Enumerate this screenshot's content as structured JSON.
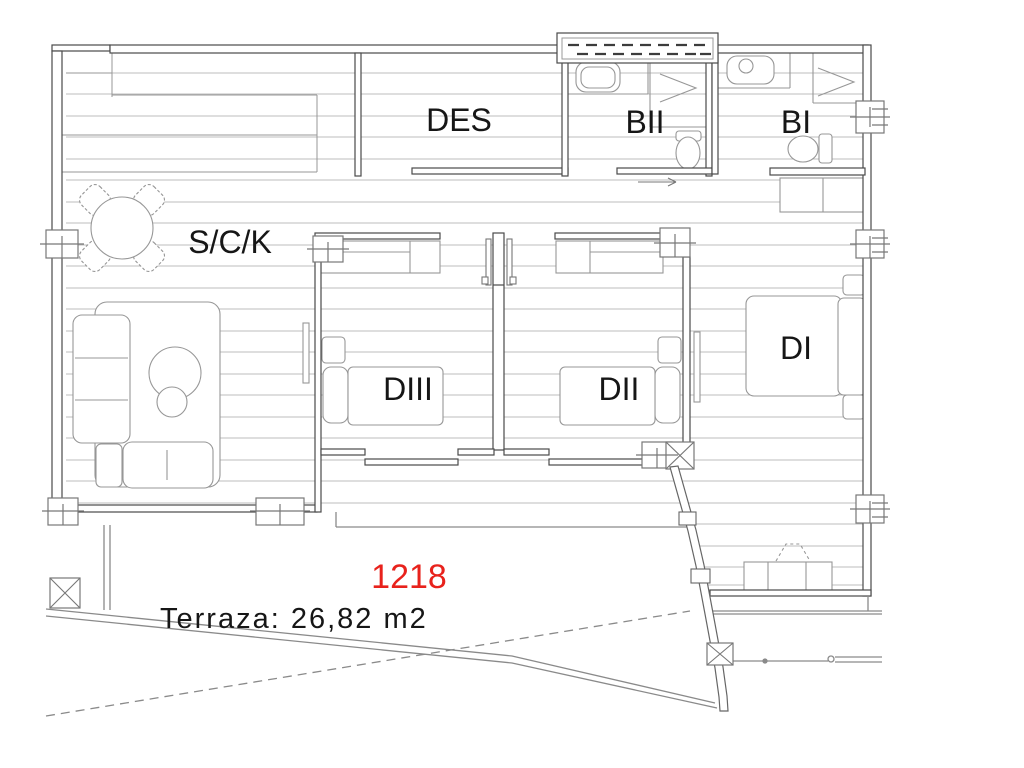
{
  "plan": {
    "unit_number": "1218",
    "terrace_label": "Terraza: 26,82 m2",
    "rooms": {
      "des": "DES",
      "bii": "BII",
      "bi": "BI",
      "sck": "S/C/K",
      "diii": "DIII",
      "dii": "DII",
      "di": "DI"
    },
    "colors": {
      "background": "#ffffff",
      "unit_number_red": "#e8221c",
      "label_black": "#161616",
      "wall": "#4a4a4a",
      "hatch": "#bdbdbd",
      "furniture": "#979797",
      "terrace_line": "#8a8a8a"
    }
  }
}
